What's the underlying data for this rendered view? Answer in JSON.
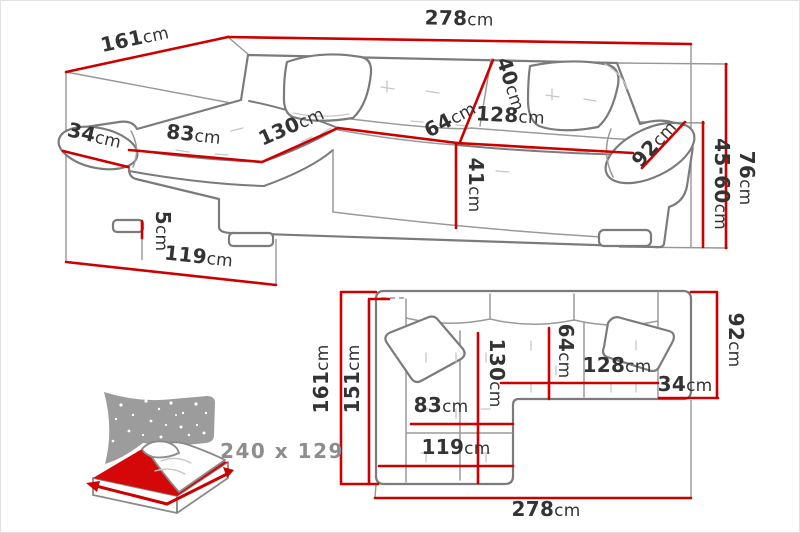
{
  "diagram_title": "corner-sofa-dimensions",
  "colors": {
    "dimension_red": "#cc0000",
    "outline_gray": "#7b7b7b",
    "text_dark": "#333333",
    "icon_gray": "#9c9c9c",
    "icon_text_gray": "#8d8d8d"
  },
  "perspective_view": {
    "dims": {
      "depth_total": {
        "value": "161",
        "unit": "cm"
      },
      "width_total": {
        "value": "278",
        "unit": "cm"
      },
      "armrest_width": {
        "value": "34",
        "unit": "cm"
      },
      "chaise_seat_width": {
        "value": "83",
        "unit": "cm"
      },
      "chaise_seat_length": {
        "value": "130",
        "unit": "cm"
      },
      "backrest_depth": {
        "value": "40",
        "unit": "cm"
      },
      "seat_depth": {
        "value": "64",
        "unit": "cm"
      },
      "seat_width": {
        "value": "128",
        "unit": "cm"
      },
      "armrest_length": {
        "value": "92",
        "unit": "cm"
      },
      "seat_height": {
        "value": "41",
        "unit": "cm"
      },
      "leg_height": {
        "value": "5",
        "unit": "cm"
      },
      "chaise_outer_length": {
        "value": "119",
        "unit": "cm"
      },
      "armrest_height": {
        "value": "45-60",
        "unit": "cm"
      },
      "total_height": {
        "value": "76",
        "unit": "cm"
      }
    }
  },
  "plan_view": {
    "dims": {
      "depth_total": {
        "value": "161",
        "unit": "cm"
      },
      "depth_inner": {
        "value": "151",
        "unit": "cm"
      },
      "chaise_length": {
        "value": "130",
        "unit": "cm"
      },
      "seat_depth": {
        "value": "64",
        "unit": "cm"
      },
      "seat_width": {
        "value": "128",
        "unit": "cm"
      },
      "armrest_width": {
        "value": "34",
        "unit": "cm"
      },
      "side_depth": {
        "value": "92",
        "unit": "cm"
      },
      "chaise_seat_width": {
        "value": "83",
        "unit": "cm"
      },
      "chaise_outer_length": {
        "value": "119",
        "unit": "cm"
      },
      "width_total": {
        "value": "278",
        "unit": "cm"
      }
    }
  },
  "sleeping_area": {
    "label": "240 x 129"
  }
}
